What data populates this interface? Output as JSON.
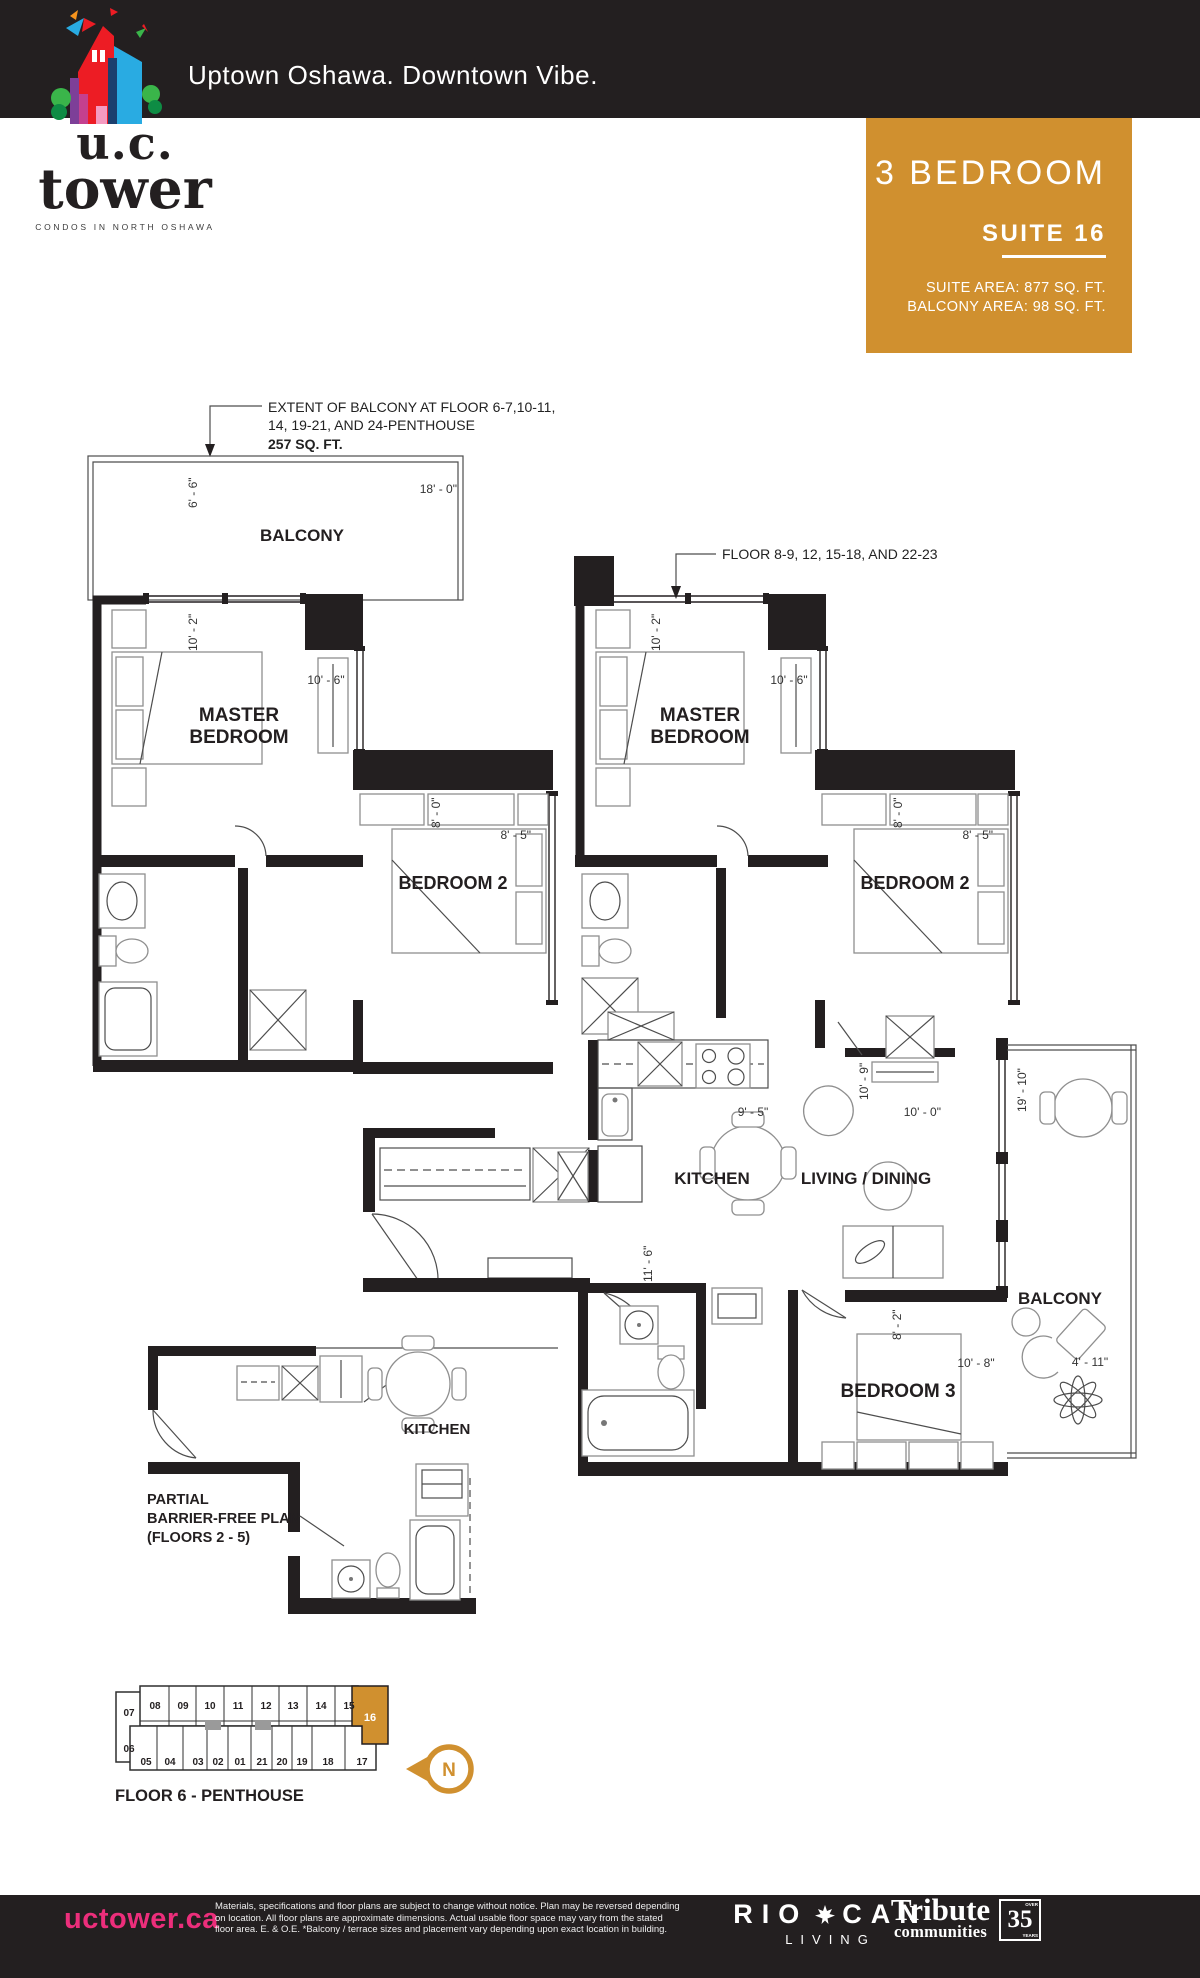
{
  "colors": {
    "ink": "#231F20",
    "gold": "#D0902F",
    "pink": "#EC2E7B"
  },
  "header": {
    "tagline": "Uptown Oshawa. Downtown Vibe."
  },
  "logo": {
    "name_top": "u.c.",
    "name_bottom": "tower",
    "tagline": "CONDOS IN NORTH OSHAWA"
  },
  "badge": {
    "type": "3 BEDROOM",
    "suite": "SUITE 16",
    "area_line1": "SUITE AREA: 877 SQ. FT.",
    "area_line2": "BALCONY AREA: 98 SQ. FT."
  },
  "notes": {
    "extent_line1": "EXTENT OF BALCONY AT FLOOR 6-7,10-11,",
    "extent_line2": "14, 19-21, AND 24-PENTHOUSE",
    "extent_line3": "257 SQ. FT.",
    "floors": "FLOOR 8-9, 12, 15-18, AND 22-23"
  },
  "plan_left": {
    "balcony": "BALCONY",
    "master_line1": "MASTER",
    "master_line2": "BEDROOM",
    "bedroom2": "BEDROOM 2",
    "dim_balcony_depth": "6' - 6\"",
    "dim_balcony_width": "18' - 0\"",
    "dim_master_width": "10' - 2\"",
    "dim_master_closet": "10' - 6\"",
    "dim_bed2_width": "8' - 0\"",
    "dim_bed2_depth": "8' - 5\""
  },
  "plan_right": {
    "master_line1": "MASTER",
    "master_line2": "BEDROOM",
    "bedroom2": "BEDROOM 2",
    "kitchen": "KITCHEN",
    "living": "LIVING / DINING",
    "balcony": "BALCONY",
    "bedroom3": "BEDROOM 3",
    "dim_master_width": "10' - 2\"",
    "dim_master_closet": "10' - 6\"",
    "dim_bed2_width": "8' - 0\"",
    "dim_bed2_depth": "8' - 5\"",
    "dim_kitchen": "9' - 5\"",
    "dim_living_width": "10' - 0\"",
    "dim_living_depth": "10' - 9\"",
    "dim_balcony_depth": "19' - 10\"",
    "dim_hall": "11' - 6\"",
    "dim_bed3_depth": "8' - 2\"",
    "dim_bed3_width": "10' - 8\"",
    "dim_balcony_width": "4' - 11\""
  },
  "partial_plan": {
    "line1": "PARTIAL",
    "line2": "BARRIER-FREE PLAN",
    "line3": "(FLOORS 2 - 5)",
    "kitchen": "KITCHEN"
  },
  "keyplan": {
    "floor_label": "FLOOR 6 - PENTHOUSE",
    "north": "N",
    "highlighted_unit": "16",
    "top_row": [
      "07",
      "08",
      "09",
      "10",
      "11",
      "12",
      "13",
      "14",
      "15"
    ],
    "bottom_row": [
      "06",
      "05",
      "04",
      "03",
      "02",
      "01",
      "21",
      "20",
      "19",
      "18",
      "17"
    ]
  },
  "footer": {
    "website": "uctower.ca",
    "disclaimer_line1": "Materials, specifications and floor plans are subject to change without notice. Plan may be reversed depending",
    "disclaimer_line2": "on location. All floor plans are approximate dimensions. Actual usable floor space may vary from the stated",
    "disclaimer_line3": "floor area.  E. & O.E.  *Balcony / terrace sizes and placement vary depending upon exact location in building.",
    "riocan_left": "RIO",
    "riocan_right": "CAN",
    "riocan_sub": "LIVING",
    "tribute_line1": "Tribute",
    "tribute_line2": "communities",
    "years_number": "35",
    "years_over": "OVER",
    "years_label": "YEARS"
  }
}
